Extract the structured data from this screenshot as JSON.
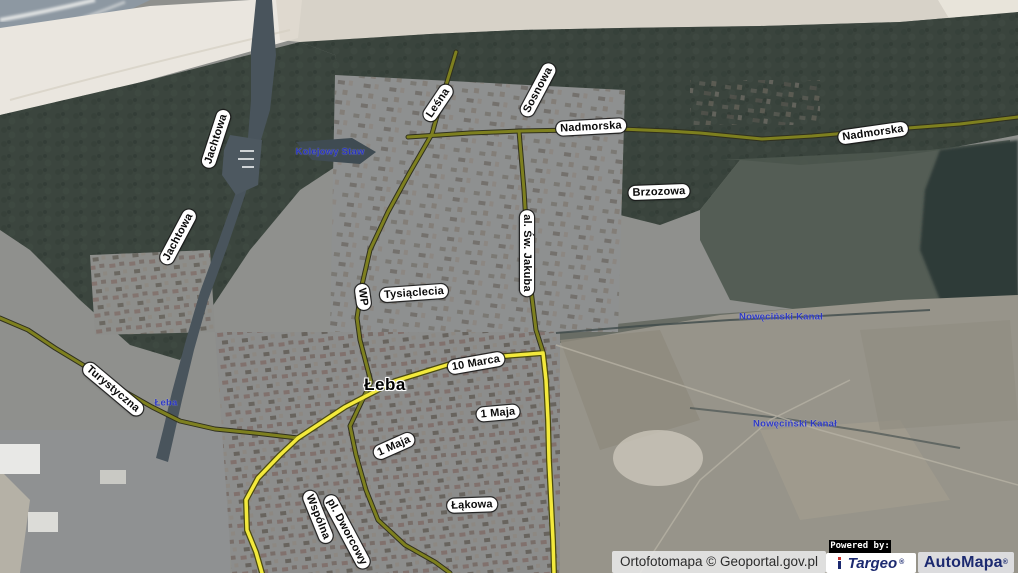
{
  "map": {
    "type": "satellite-orthophoto-with-street-overlay",
    "town": "Łeba",
    "labels": [
      {
        "text": "Jachtowa",
        "kind": "street",
        "x": 216,
        "y": 139,
        "rot": -72
      },
      {
        "text": "Jachtowa",
        "kind": "street",
        "x": 178,
        "y": 237,
        "rot": -62
      },
      {
        "text": "Leśna",
        "kind": "street",
        "x": 438,
        "y": 103,
        "rot": -56
      },
      {
        "text": "Sosnowa",
        "kind": "street",
        "x": 538,
        "y": 90,
        "rot": -62
      },
      {
        "text": "Nadmorska",
        "kind": "street",
        "x": 591,
        "y": 127,
        "rot": -3
      },
      {
        "text": "Nadmorska",
        "kind": "street",
        "x": 873,
        "y": 133,
        "rot": -8
      },
      {
        "text": "Brzozowa",
        "kind": "street",
        "x": 659,
        "y": 192,
        "rot": -2
      },
      {
        "text": "al. Św. Jakuba",
        "kind": "street",
        "x": 527,
        "y": 253,
        "rot": 90
      },
      {
        "text": "WP",
        "kind": "street",
        "x": 363,
        "y": 297,
        "rot": 82
      },
      {
        "text": "Tysiąclecia",
        "kind": "street",
        "x": 414,
        "y": 293,
        "rot": -4
      },
      {
        "text": "Turystyczna",
        "kind": "street",
        "x": 113,
        "y": 389,
        "rot": 40
      },
      {
        "text": "10 Marca",
        "kind": "street",
        "x": 476,
        "y": 363,
        "rot": -10
      },
      {
        "text": "1 Maja",
        "kind": "street",
        "x": 498,
        "y": 413,
        "rot": -5
      },
      {
        "text": "1 Maja",
        "kind": "street",
        "x": 394,
        "y": 446,
        "rot": -24
      },
      {
        "text": "Łąkowa",
        "kind": "street",
        "x": 472,
        "y": 505,
        "rot": -2
      },
      {
        "text": "Wspólna",
        "kind": "street",
        "x": 318,
        "y": 517,
        "rot": 68
      },
      {
        "text": "pl. Dworcowy",
        "kind": "street",
        "x": 347,
        "y": 532,
        "rot": 62
      },
      {
        "text": "Łeba",
        "kind": "town",
        "x": 385,
        "y": 385,
        "rot": 0
      },
      {
        "text": "Kolejowy Staw",
        "kind": "water",
        "x": 330,
        "y": 152,
        "rot": 0
      },
      {
        "text": "Łeba",
        "kind": "water",
        "x": 166,
        "y": 403,
        "rot": 0
      },
      {
        "text": "Nowęciński Kanał",
        "kind": "water",
        "x": 781,
        "y": 317,
        "rot": 0
      },
      {
        "text": "Nowęciński Kanał",
        "kind": "water",
        "x": 795,
        "y": 424,
        "rot": 0
      }
    ]
  },
  "attribution": {
    "ortofotomapa": "Ortofotomapa © Geoportal.gov.pl",
    "powered_by": "Powered by:",
    "targeo": "Targeo",
    "targeo_reg": "®",
    "automapa": "AutoMapa",
    "automapa_reg": "®"
  },
  "colors": {
    "road_major": "#f3e93c",
    "road_major_casing": "#4a4a10",
    "road_minor": "#7e801f",
    "road_minor_casing": "#30301e",
    "water_label": "#2733c8",
    "street_label_bg": "#ffffff",
    "street_label_text": "#0a0a0a",
    "logo_navy": "#1c2a70"
  }
}
